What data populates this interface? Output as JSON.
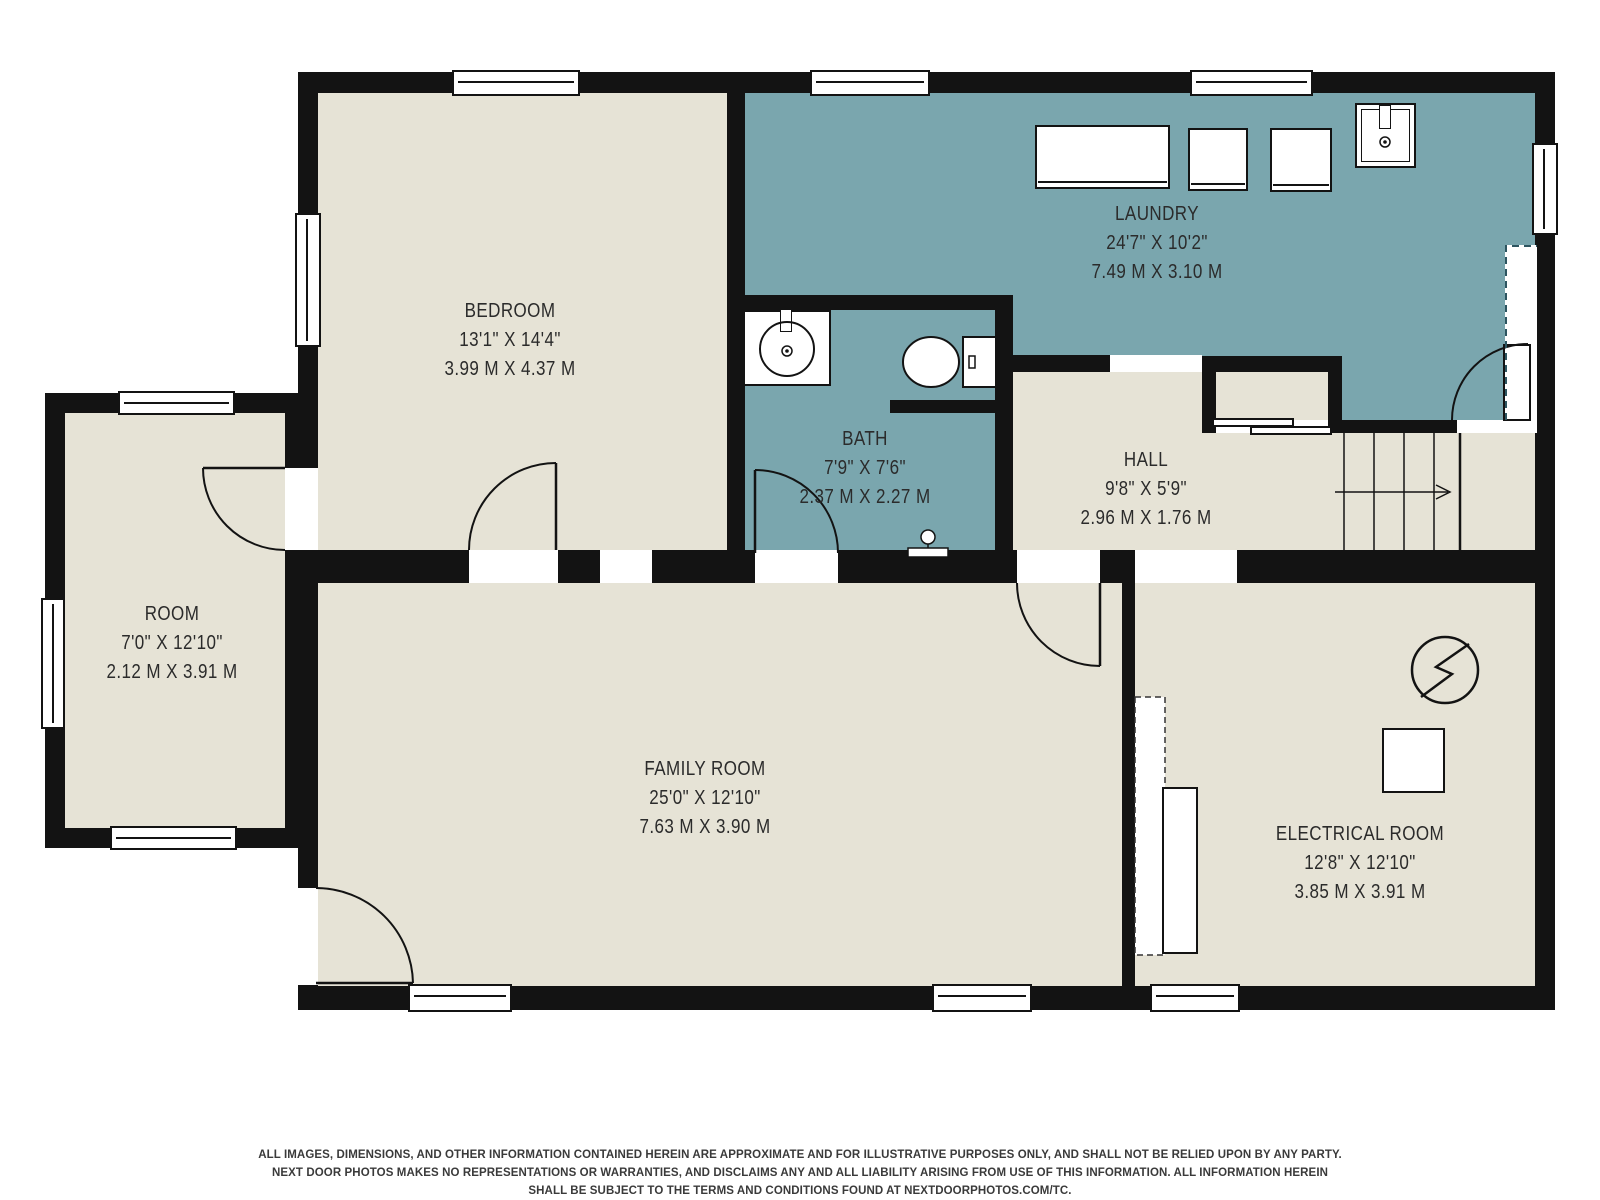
{
  "title": "Basement floor plan",
  "colors": {
    "bg": "#ffffff",
    "room": "#e6e3d6",
    "wet": "#7aa6ae",
    "wall": "#131313",
    "dash": "#2d5560",
    "text": "#2b2b2b"
  },
  "rooms": [
    {
      "id": "bedroom",
      "name": "BEDROOM",
      "imperial": "13'1\" X 14'4\"",
      "metric": "3.99 M X 4.37 M"
    },
    {
      "id": "laundry",
      "name": "LAUNDRY",
      "imperial": "24'7\" X 10'2\"",
      "metric": "7.49 M X 3.10 M"
    },
    {
      "id": "bath",
      "name": "BATH",
      "imperial": "7'9\" X 7'6\"",
      "metric": "2.37 M X 2.27 M"
    },
    {
      "id": "hall",
      "name": "HALL",
      "imperial": "9'8\" X 5'9\"",
      "metric": "2.96 M X 1.76 M"
    },
    {
      "id": "room",
      "name": "ROOM",
      "imperial": "7'0\" X 12'10\"",
      "metric": "2.12 M X 3.91 M"
    },
    {
      "id": "family_room",
      "name": "FAMILY ROOM",
      "imperial": "25'0\" X 12'10\"",
      "metric": "7.63 M X 3.90 M"
    },
    {
      "id": "electrical_room",
      "name": "ELECTRICAL ROOM",
      "imperial": "12'8\" X 12'10\"",
      "metric": "3.85 M X 3.91 M"
    }
  ],
  "disclaimer": {
    "line1": "ALL IMAGES, DIMENSIONS, AND OTHER INFORMATION CONTAINED HEREIN ARE APPROXIMATE AND FOR ILLUSTRATIVE PURPOSES ONLY, AND SHALL NOT BE RELIED UPON BY ANY PARTY.",
    "line2": "NEXT DOOR PHOTOS MAKES NO REPRESENTATIONS OR WARRANTIES, AND DISCLAIMS ANY AND ALL LIABILITY ARISING FROM USE OF THIS INFORMATION. ALL INFORMATION HEREIN",
    "line3": "SHALL BE SUBJECT TO THE TERMS AND CONDITIONS FOUND AT NEXTDOORPHOTOS.COM/TC."
  }
}
